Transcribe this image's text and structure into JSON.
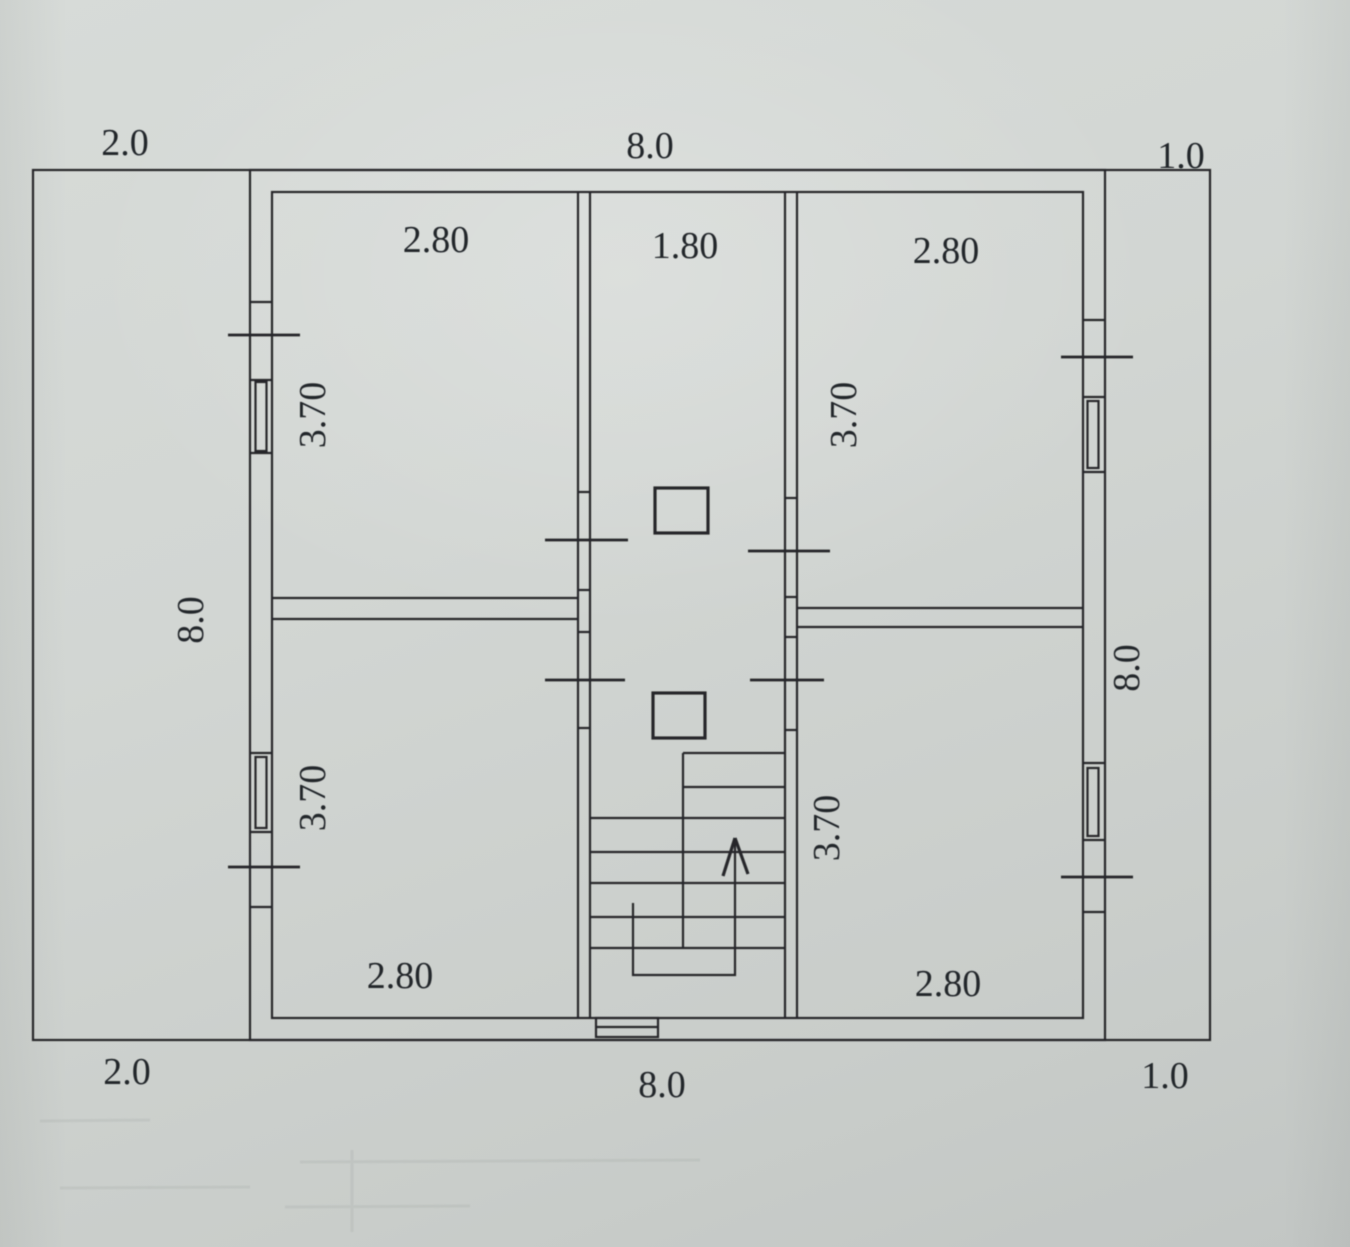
{
  "drawing": {
    "kind": "house floor plan, second storey, scanned pencil-and-ink blueprint on grey paper",
    "paper_color": "#d2d6d3",
    "line_color": "#25272a",
    "dimensions": {
      "top": {
        "left": "2.0",
        "center": "8.0",
        "right": "1.0"
      },
      "bottom": {
        "left": "2.0",
        "center": "8.0",
        "right": "1.0"
      },
      "left_side": "8.0",
      "right_side": "8.0"
    },
    "rooms": {
      "upper_left": {
        "width": "2.80",
        "depth": "3.70"
      },
      "hall": {
        "width": "1.80"
      },
      "upper_right": {
        "width": "2.80",
        "depth": "3.70"
      },
      "lower_left": {
        "width": "2.80",
        "depth": "3.70"
      },
      "lower_right": {
        "width": "2.80",
        "depth": "3.70"
      }
    },
    "stairs": {
      "arrow_direction": "up"
    }
  }
}
